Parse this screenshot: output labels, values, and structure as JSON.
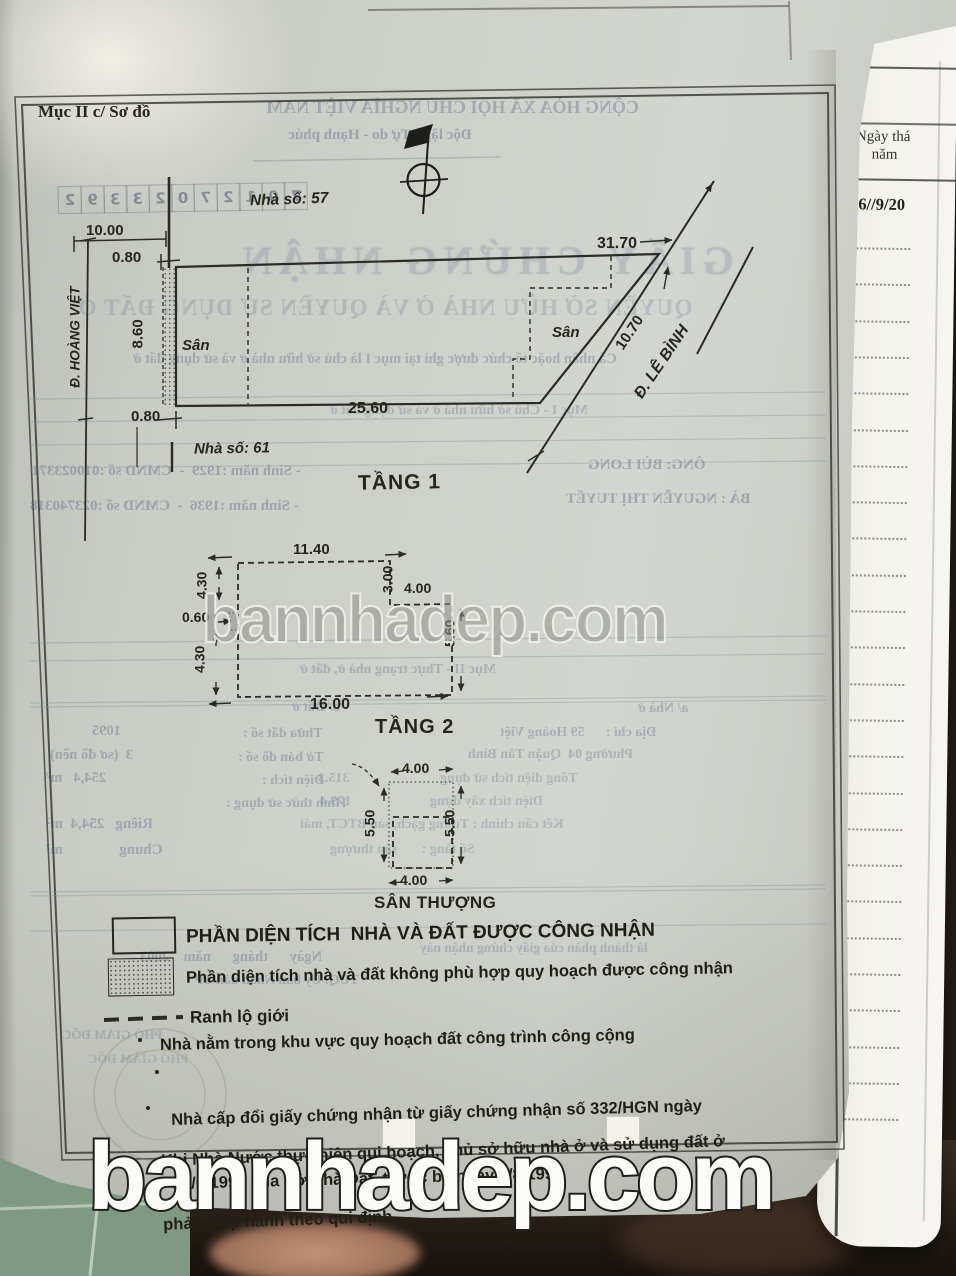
{
  "colors": {
    "paper": "#cdd0c8",
    "side_paper": "#f3f2ec",
    "ink": "#2b2b26",
    "bleed_ink": "#6f7a96",
    "tile_green": "#7f9a82",
    "background_dark": "#241c15",
    "watermark_gray": "#9b9e98"
  },
  "watermark": {
    "text": "bannhadep.com"
  },
  "doc": {
    "section_label": "Mục II c/ Sơ đồ",
    "site_plan": {
      "house_no_top": "Nhà số: 57",
      "house_no_bottom": "Nhà số: 61",
      "dim_10_00": "10.00",
      "dim_0_80_top": "0.80",
      "dim_8_60": "8.60",
      "dim_0_80_bottom": "0.80",
      "dim_31_70": "31.70",
      "dim_25_60": "25.60",
      "dim_10_70": "10.70",
      "street_left": "Đ. HOÀNG VIỆT",
      "street_right": "Đ. LÊ BÌNH",
      "yard_left": "Sân",
      "yard_right": "Sân"
    },
    "floor1": {
      "title": "TẦNG 1",
      "dim_top": "11.40",
      "dim_left_upper": "4.30",
      "dim_left_mid": "0.60",
      "dim_left_lower": "4.30",
      "dim_notch_v": "3.00",
      "dim_notch_h": "4.00",
      "dim_right": "5.60",
      "dim_bottom": "16.00"
    },
    "floor2": {
      "title": "TẦNG 2",
      "dim_top": "4.00",
      "dim_left": "5.50",
      "dim_right": "5.50",
      "dim_bottom": "4.00",
      "roof_label": "SÂN THƯỢNG"
    },
    "legend": {
      "row1": "PHẦN DIỆN TÍCH  NHÀ VÀ ĐẤT ĐƯỢC CÔNG NHẬN",
      "row2": "Phần diện tích nhà và đất không phù hợp quy hoạch được công nhận",
      "row3": "Ranh lộ giới",
      "row4": "Nhà nằm trong khu vực quy hoạch đất công trình công cộng",
      "row5a": "Nhà cấp đổi giấy chứng nhận từ giấy chứng nhận số 332/HGN ngày",
      "row5b": "27/6/1991 của Sở Nhà Đất, trước bạ ngày 3/8/1991",
      "row6a": "Khi Nhà Nước thực hiện qui hoạch, chủ sở hữu nhà ở và sử dụng đất ở",
      "row6b": "phải chấp hành theo qui định"
    }
  },
  "side_page": {
    "header_line1": "Ngày thá",
    "header_line2": "năm",
    "date": "06//9/20"
  },
  "bleed": {
    "serial": [
      "7",
      "0",
      "1",
      "2",
      "7",
      "0",
      "2",
      "3",
      "3",
      "9",
      "2"
    ],
    "national_motto_1": "CỘNG HÒA XÃ HỘI CHỦ NGHĨA VIỆT NAM",
    "national_motto_2": "Độc lập - Tự do - Hạnh phúc",
    "cert_title": "GIẤY CHỨNG NHẬN",
    "cert_subtitle": "QUYỀN SỞ HỮU NHÀ Ở VÀ QUYỀN SỬ DỤNG ĐẤT Ở",
    "note_line": "Cá nhân hoặc tổ chức được ghi tại mục I là chủ sở hữu nhà ở và sử dụng đất ở",
    "muc1": "Mục I - Chủ sở hữu nhà ở và sử dụng đất ở",
    "owner1": "ÔNG: BÙI LONG",
    "owner1_info": "- Sinh năm :1929  -  CMND số :010023371",
    "owner2": "BÀ : NGUYỄN THỊ TUYẾT",
    "owner2_info": "- Sinh năm :1936  -  CMND số :023740318",
    "muc2": "Mục II - Thực trạng nhà ở, đất ở",
    "sec_a": "a/ Nhà ở",
    "addr": "Địa chỉ :      59 Hoàng Việt",
    "ward": "Phường 04  Quận Tân Bình",
    "total_area": "Tổng diện tích sử dụng",
    "total_area_val": "315.3",
    "build_area": "Diện tích xây dựng",
    "build_area_val": "179.4",
    "structure": "Kết cấu chính : Tường gạch, sàn BTCT, mái",
    "floors": "Số tầng :       sân thượng",
    "sec_b": "b/ Đất ở",
    "parcel": "Thửa đất số :",
    "parcel_val": "1095",
    "map_sheet": "Tờ bản đồ số :",
    "map_sheet_val": "3  (sơ đồ nền)",
    "area": "Diện tích :",
    "area_val": "254,4   m²",
    "usage": "Hình thức sử dụng :",
    "private": "Riêng   254,4  m²",
    "shared": "Chung               m²",
    "cert_note": "là thành phần của giấy chứng nhận này",
    "date_line": "Ngày      tháng      năm    2003",
    "sign_line": "TUQ. Ủy ban Nhân dân TP",
    "sign_title": "PHÓ GIÁM ĐỐC"
  }
}
